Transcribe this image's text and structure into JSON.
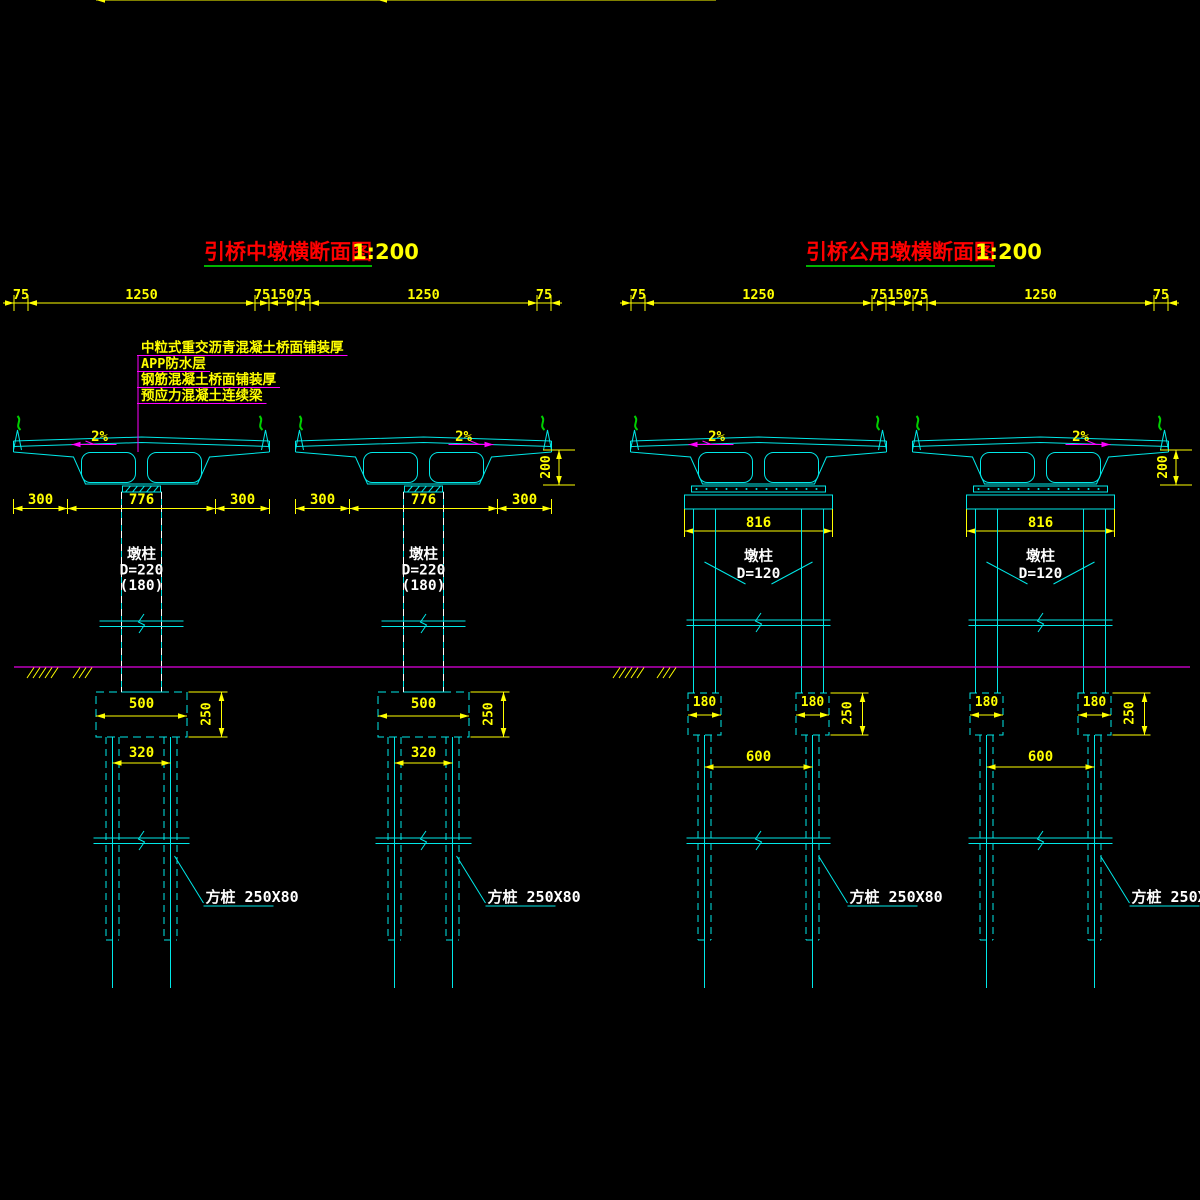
{
  "drawing": {
    "background": "#000000",
    "colors": {
      "geometry": "#00e8e8",
      "dimension": "#ffff00",
      "title": "#ff0000",
      "scale_text": "#ffff00",
      "note_text": "#ffff00",
      "leader": "#ff00ff",
      "ground": "#e100e1",
      "label_text": "#ffffff",
      "underline": "#00b400",
      "railing": "#00d000",
      "hidden": "#ffffff"
    },
    "views": [
      {
        "id": "mid-pier",
        "title": "引桥中墩横断面图",
        "scale": "1:200",
        "top_dimensions": [
          "75",
          "1250",
          "75",
          "150",
          "75",
          "1250",
          "75"
        ],
        "notes": [
          "中粒式重交沥青混凝土桥面铺装厚",
          "APP防水层",
          "钢筋混凝土桥面铺装厚",
          "预应力混凝土连续梁"
        ],
        "slope_label": "2%",
        "girder_depth_dim": "200",
        "under_girder_dims": [
          "300",
          "776",
          "300"
        ],
        "pier_label": [
          "墩柱",
          "D=220",
          "(180)"
        ],
        "cap_width_dim": "500",
        "cap_height_dim": "250",
        "pile_spacing_dim": "320",
        "pile_label": "方桩 250X80"
      },
      {
        "id": "shared-pier",
        "title": "引桥公用墩横断面图",
        "scale": "1:200",
        "top_dimensions": [
          "75",
          "1250",
          "75",
          "150",
          "75",
          "1250",
          "75"
        ],
        "slope_label": "2%",
        "girder_depth_dim": "200",
        "cap_beam_width_dim": "816",
        "pier_label": [
          "墩柱",
          "D=120"
        ],
        "footing_width_dim": "180",
        "footing_height_dim": "250",
        "pile_spacing_dim": "600",
        "pile_label": "方桩 250X80"
      }
    ]
  }
}
